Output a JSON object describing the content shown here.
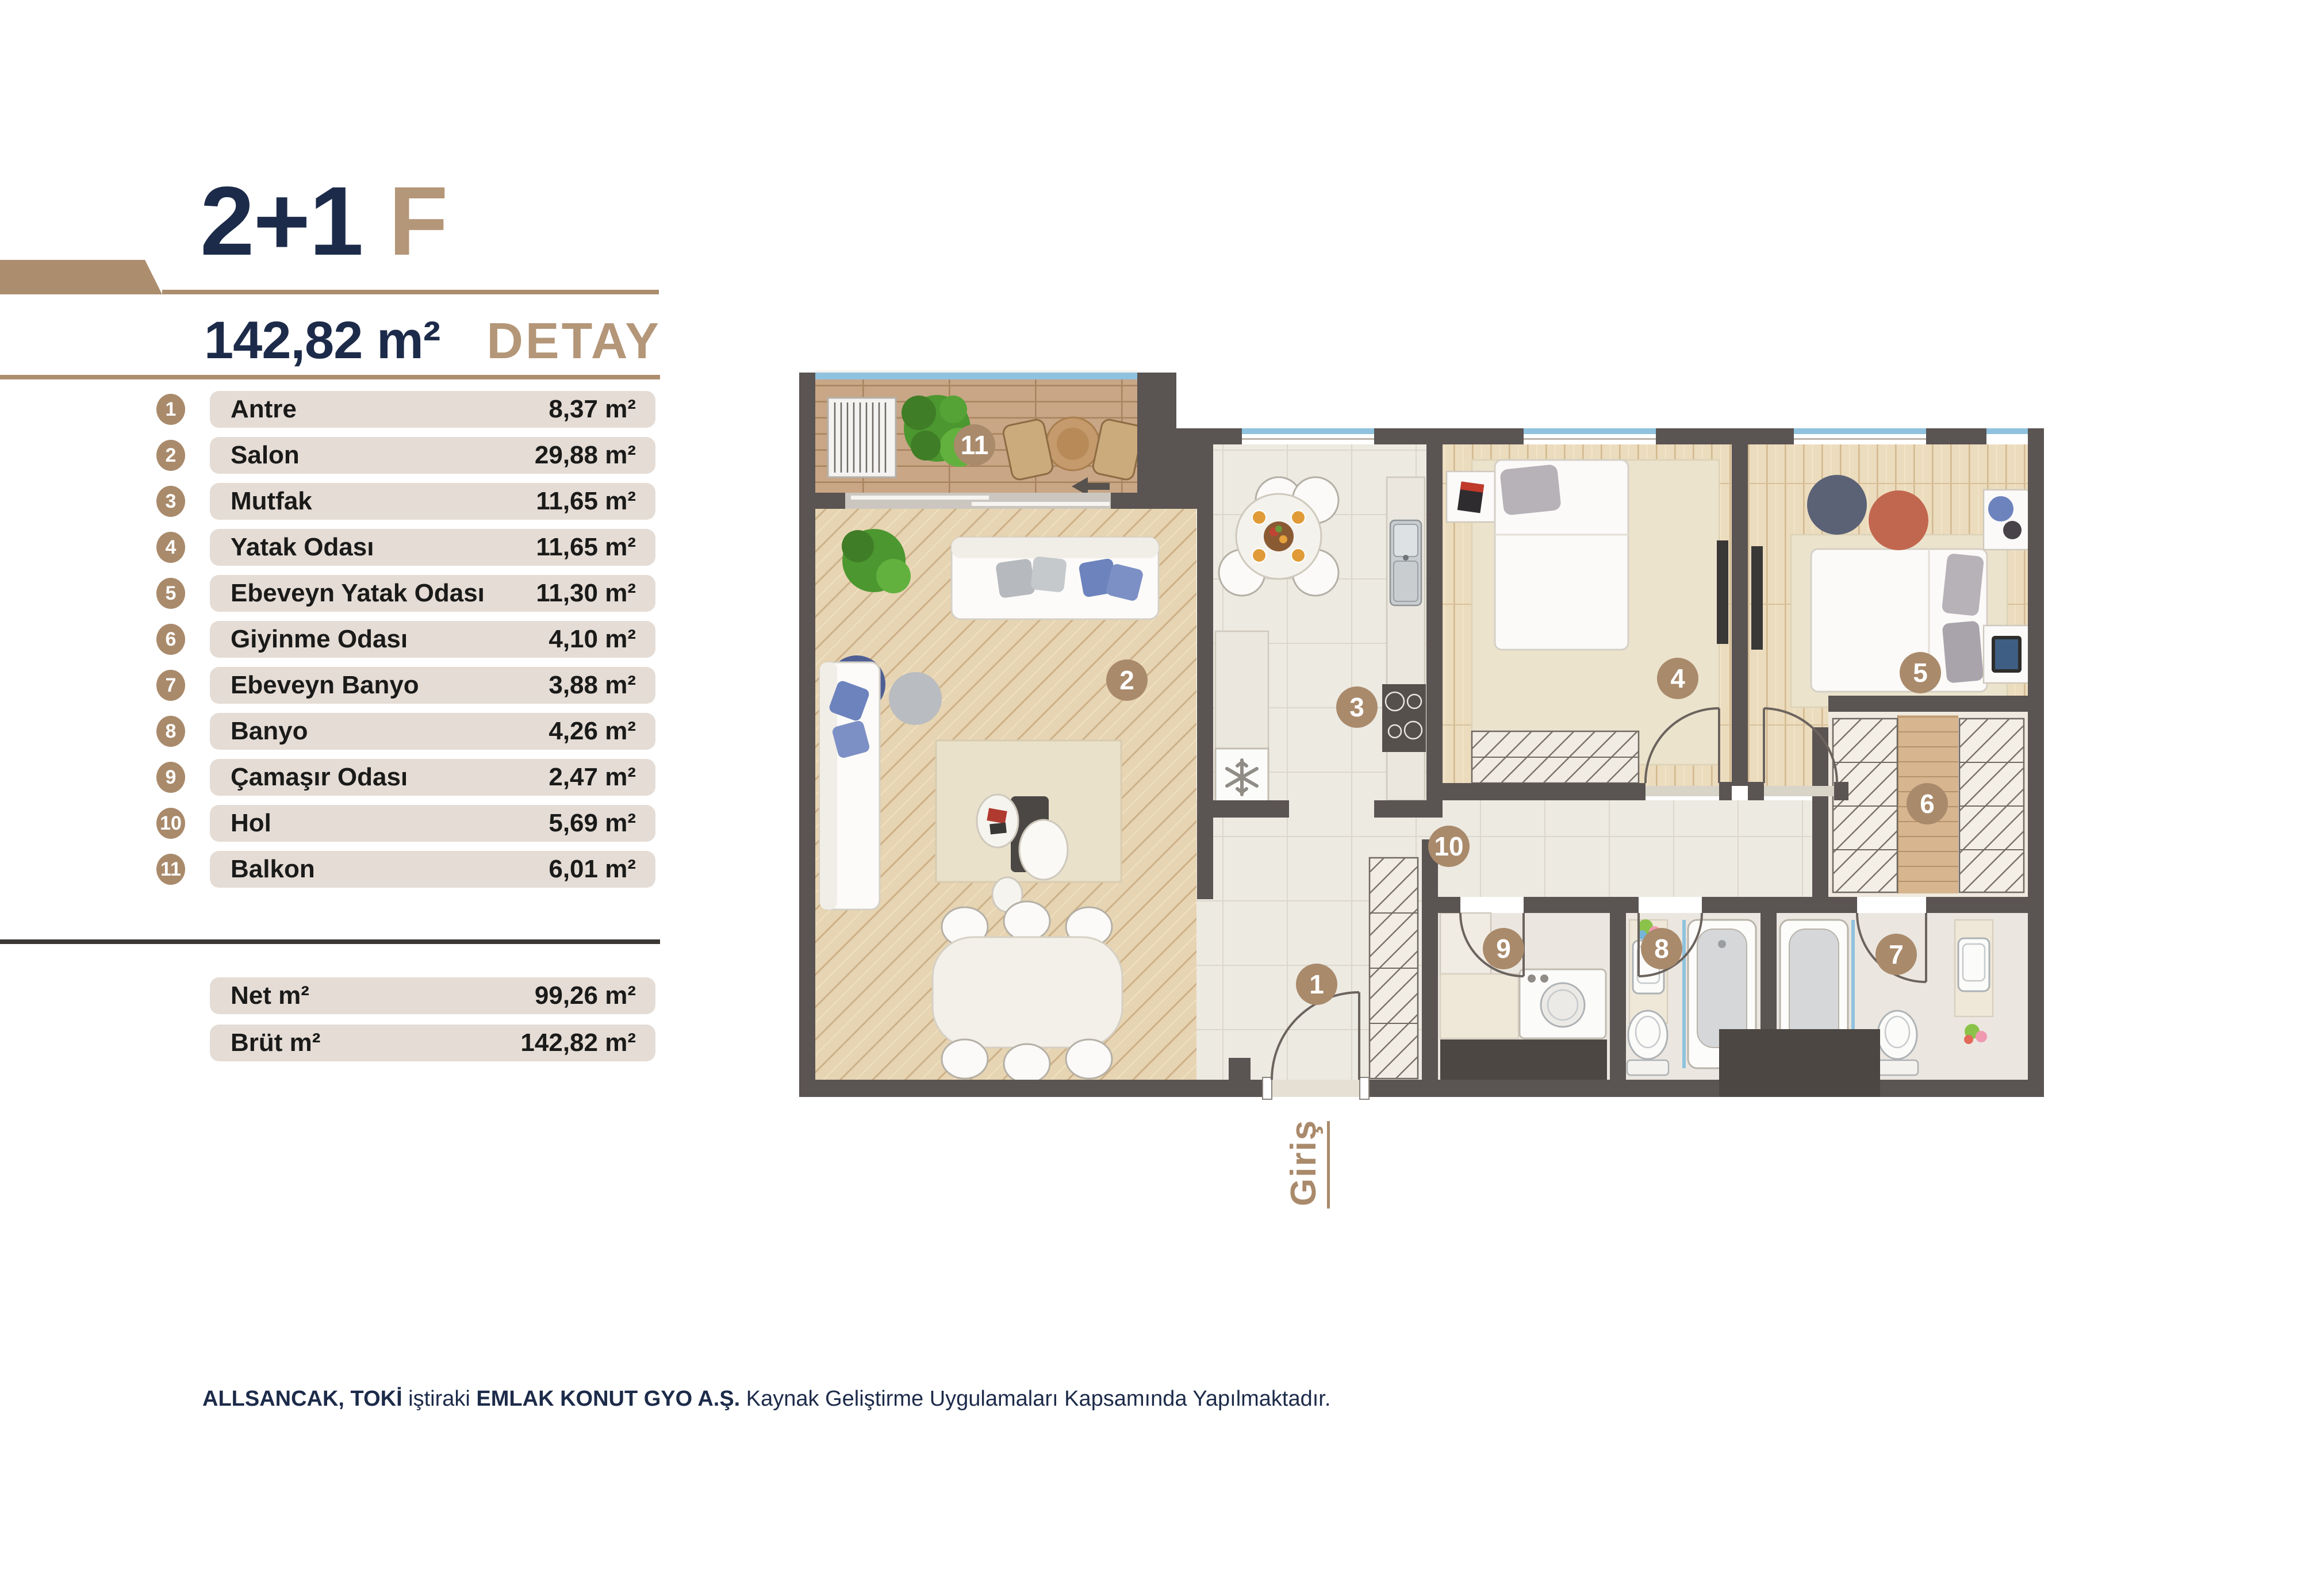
{
  "title": {
    "type": "2+1",
    "variant": "F",
    "area": "142,82 m²",
    "detail": "DETAY"
  },
  "legend": {
    "rooms": [
      {
        "no": "1",
        "name": "Antre",
        "area": "8,37 m²"
      },
      {
        "no": "2",
        "name": "Salon",
        "area": "29,88 m²"
      },
      {
        "no": "3",
        "name": "Mutfak",
        "area": "11,65 m²"
      },
      {
        "no": "4",
        "name": "Yatak Odası",
        "area": "11,65 m²"
      },
      {
        "no": "5",
        "name": "Ebeveyn Yatak Odası",
        "area": "11,30 m²"
      },
      {
        "no": "6",
        "name": "Giyinme Odası",
        "area": "4,10 m²"
      },
      {
        "no": "7",
        "name": "Ebeveyn Banyo",
        "area": "3,88 m²"
      },
      {
        "no": "8",
        "name": "Banyo",
        "area": "4,26 m²"
      },
      {
        "no": "9",
        "name": "Çamaşır Odası",
        "area": "2,47 m²"
      },
      {
        "no": "10",
        "name": "Hol",
        "area": "5,69 m²"
      },
      {
        "no": "11",
        "name": "Balkon",
        "area": "6,01 m²"
      }
    ]
  },
  "totals": [
    {
      "label": "Net m²",
      "value": "99,26 m²"
    },
    {
      "label": "Brüt m²",
      "value": "142,82 m²"
    }
  ],
  "plan": {
    "entrance_label": "Giriş",
    "badges": [
      "1",
      "2",
      "3",
      "4",
      "5",
      "6",
      "7",
      "8",
      "9",
      "10",
      "11"
    ]
  },
  "footer": {
    "brand": "ALLSANCAK, TOKİ",
    "mid": " iştiraki ",
    "company": "EMLAK KONUT GYO A.Ş.",
    "rest": " Kaynak Geliştirme Uygulamaları Kapsamında Yapılmaktadır."
  },
  "colors": {
    "navy": "#1d2b4a",
    "tan": "#ac8d6e",
    "pill": "#e4dcd5",
    "wall": "#5a5452",
    "glass": "#8fc2de",
    "badge": "#a98a6b"
  }
}
